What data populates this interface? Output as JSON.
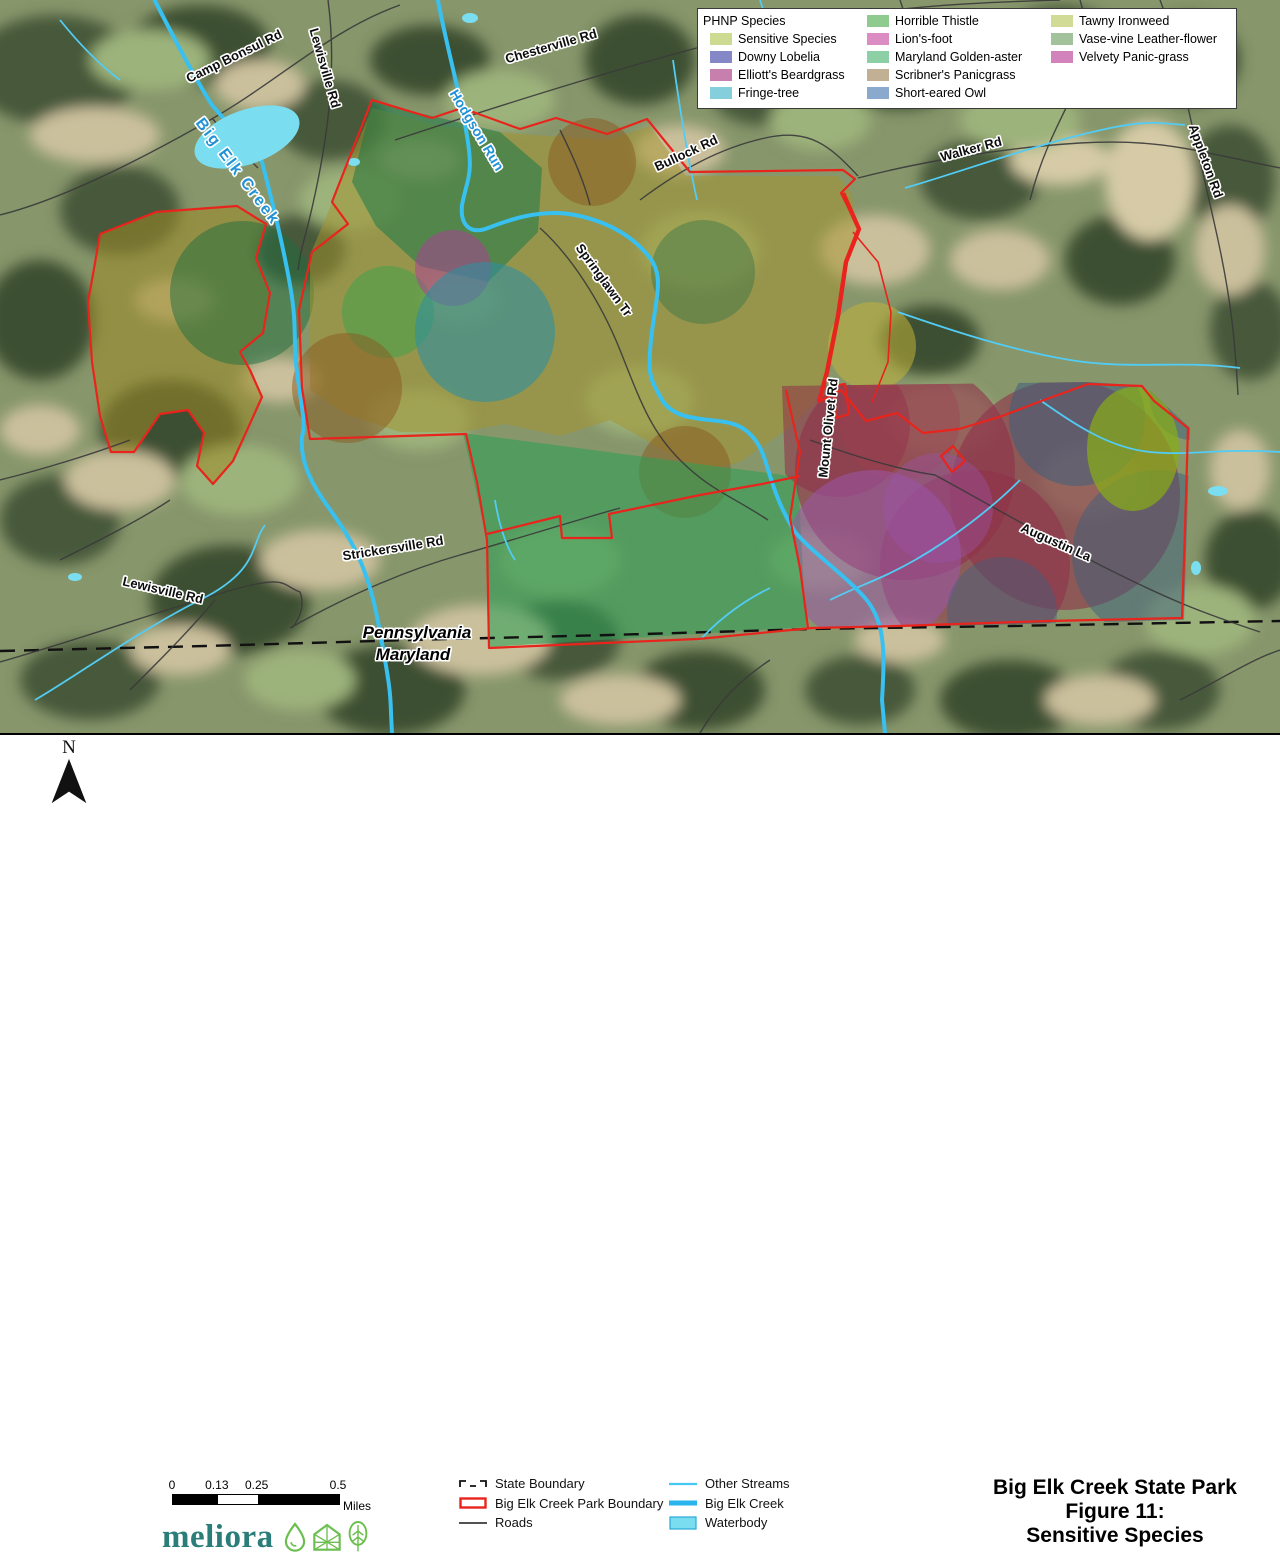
{
  "phnp_legend": {
    "title": "PHNP Species",
    "columns": [
      {
        "items": [
          {
            "label": "Sensitive Species",
            "color": "#cdda92"
          },
          {
            "label": "Downy Lobelia",
            "color": "#8588c7"
          },
          {
            "label": "Elliott's Beardgrass",
            "color": "#c77fad"
          },
          {
            "label": "Fringe-tree",
            "color": "#85cfdd"
          }
        ]
      },
      {
        "items": [
          {
            "label": "Horrible Thistle",
            "color": "#8fcb8f"
          },
          {
            "label": "Lion's-foot",
            "color": "#da8cc3"
          },
          {
            "label": "Maryland Golden-aster",
            "color": "#8ed0a6"
          },
          {
            "label": "Scribner's Panicgrass",
            "color": "#c1b093"
          },
          {
            "label": "Short-eared Owl",
            "color": "#8ba9cc"
          }
        ]
      },
      {
        "items": [
          {
            "label": "Tawny Ironweed",
            "color": "#d2db95"
          },
          {
            "label": "Vase-vine Leather-flower",
            "color": "#a2c29b"
          },
          {
            "label": "Velvety Panic-grass",
            "color": "#d383bb"
          }
        ]
      }
    ]
  },
  "footer": {
    "north_label": "N",
    "scale_bar": {
      "ticks": [
        "0",
        "0.13",
        "0.25",
        "0.5"
      ],
      "tick_pos": [
        0,
        27,
        51,
        100
      ],
      "unit": "Miles"
    },
    "logo": {
      "text": "meliora"
    },
    "line_legend": [
      {
        "label": "State Boundary",
        "symbol": "state-boundary"
      },
      {
        "label": "Big Elk Creek Park Boundary",
        "symbol": "park-boundary"
      },
      {
        "label": "Roads",
        "symbol": "road"
      }
    ],
    "water_legend": [
      {
        "label": "Other Streams",
        "symbol": "stream-thin"
      },
      {
        "label": "Big Elk Creek",
        "symbol": "stream-thick"
      },
      {
        "label": "Waterbody",
        "symbol": "waterbody"
      }
    ],
    "title_lines": [
      "Big Elk Creek State Park",
      "Figure 11:",
      "Sensitive Species"
    ]
  },
  "map": {
    "road_labels": [
      {
        "text": "Camp Bonsul Rd",
        "x": 234,
        "y": 56,
        "rot": -26
      },
      {
        "text": "Lewisville Rd",
        "x": 325,
        "y": 68,
        "rot": 74
      },
      {
        "text": "Chesterville Rd",
        "x": 551,
        "y": 46,
        "rot": -16
      },
      {
        "text": "Bullock Rd",
        "x": 686,
        "y": 153,
        "rot": -25
      },
      {
        "text": "Walker Rd",
        "x": 971,
        "y": 149,
        "rot": -15
      },
      {
        "text": "Appleton Rd",
        "x": 1206,
        "y": 161,
        "rot": 70
      },
      {
        "text": "Springlawn Tr",
        "x": 604,
        "y": 280,
        "rot": 54
      },
      {
        "text": "Mount Olivet Rd",
        "x": 828,
        "y": 428,
        "rot": -84
      },
      {
        "text": "Strickersville Rd",
        "x": 393,
        "y": 548,
        "rot": -9
      },
      {
        "text": "Lewisville Rd",
        "x": 163,
        "y": 590,
        "rot": 13
      },
      {
        "text": "Augustin La",
        "x": 1056,
        "y": 542,
        "rot": 24
      }
    ],
    "stream_labels": [
      {
        "text": "Big Elk Creek",
        "x": 237,
        "y": 172,
        "rot": 53,
        "big": true
      },
      {
        "text": "Hodgson Run",
        "x": 477,
        "y": 130,
        "rot": 59,
        "big": false
      }
    ],
    "state_labels": [
      {
        "text": "Pennsylvania",
        "x": 417,
        "y": 633
      },
      {
        "text": "Maryland",
        "x": 413,
        "y": 655
      }
    ],
    "colors": {
      "park_boundary": "#e8241c",
      "stream_thin": "#45c8f2",
      "stream_thick": "#29b4ec",
      "waterbody": "#7adef0",
      "road": "#3a3a3a",
      "state_line": "#111111"
    }
  }
}
